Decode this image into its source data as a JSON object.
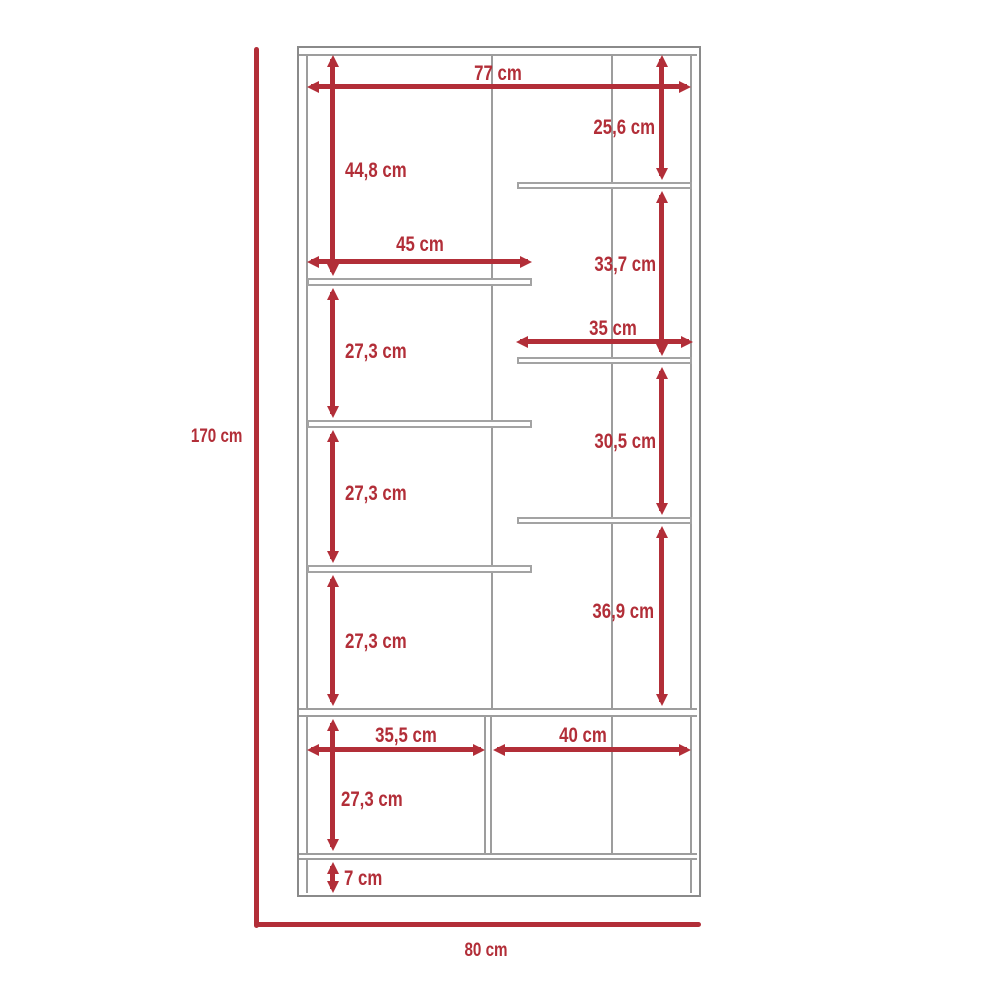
{
  "diagram": {
    "kind": "furniture-dimension-drawing",
    "unit": "cm",
    "colors": {
      "dimension_red": "#b22e38",
      "structure_gray": "#9d9d9d",
      "background": "#ffffff"
    }
  },
  "labels": {
    "overall_height": "170 cm",
    "overall_width": "80 cm",
    "inner_width": "77 cm",
    "left_top_gap": "44,8 cm",
    "left_shelf_width": "45 cm",
    "left_gap_1": "27,3 cm",
    "left_gap_2": "27,3 cm",
    "left_gap_3": "27,3 cm",
    "left_gap_4": "27,3 cm",
    "plinth_height": "7 cm",
    "right_top_gap": "25,6 cm",
    "right_shelf_width": "35 cm",
    "right_gap_1": "33,7 cm",
    "right_gap_2": "30,5 cm",
    "right_gap_3": "36,9 cm",
    "bottom_left_width": "35,5 cm",
    "bottom_right_width": "40 cm"
  },
  "measurements_cm": {
    "overall_height": 170,
    "overall_width": 80,
    "inner_width": 77,
    "left_column_gaps_top_to_bottom": [
      44.8,
      27.3,
      27.3,
      27.3,
      27.3
    ],
    "left_shelf_width": 45,
    "right_column_gaps_top_to_bottom": [
      25.6,
      33.7,
      30.5,
      36.9
    ],
    "right_shelf_width": 35,
    "bottom_compartment_widths": [
      35.5,
      40
    ],
    "plinth_height": 7
  }
}
